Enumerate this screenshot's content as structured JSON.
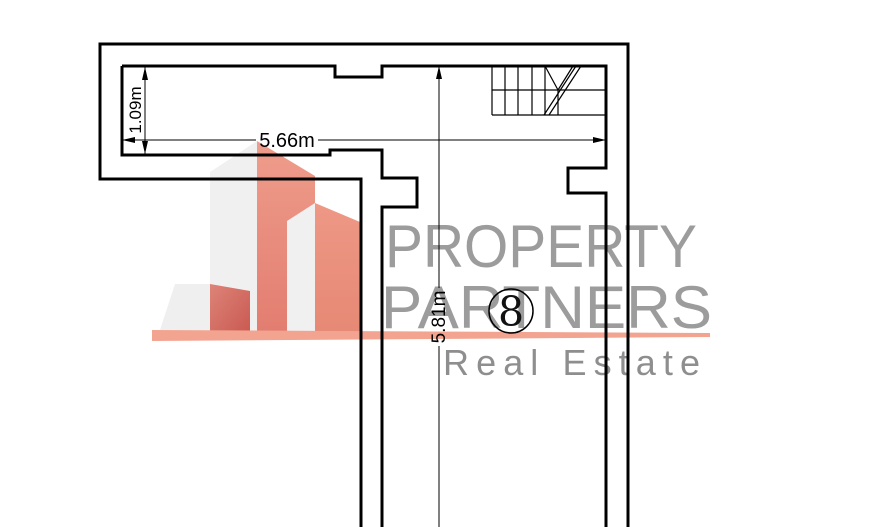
{
  "document": {
    "type": "floor-plan",
    "background_color": "#ffffff",
    "line_color": "#000000"
  },
  "floor_plan": {
    "room_number": "8",
    "dimensions": [
      {
        "id": "top-left-depth",
        "label": "1.09m",
        "orientation": "vertical"
      },
      {
        "id": "top-width",
        "label": "5.66m",
        "orientation": "horizontal"
      },
      {
        "id": "main-depth",
        "label": "5.81m",
        "orientation": "vertical"
      }
    ],
    "features": {
      "stairs": "top-right",
      "piers": "corridor-entrance-left-and-right"
    }
  },
  "watermark": {
    "line1": "PROPERTY",
    "line2": "PARTNERS",
    "line3": "Real Estate",
    "text_color": "#9c9c9c",
    "subtext_color": "#8e8e8e",
    "swoosh_color": "#f2a491",
    "building_gray": "#f1f0f1",
    "building_red_light": "#ef9d8c",
    "building_red_dark": "#c95850"
  }
}
